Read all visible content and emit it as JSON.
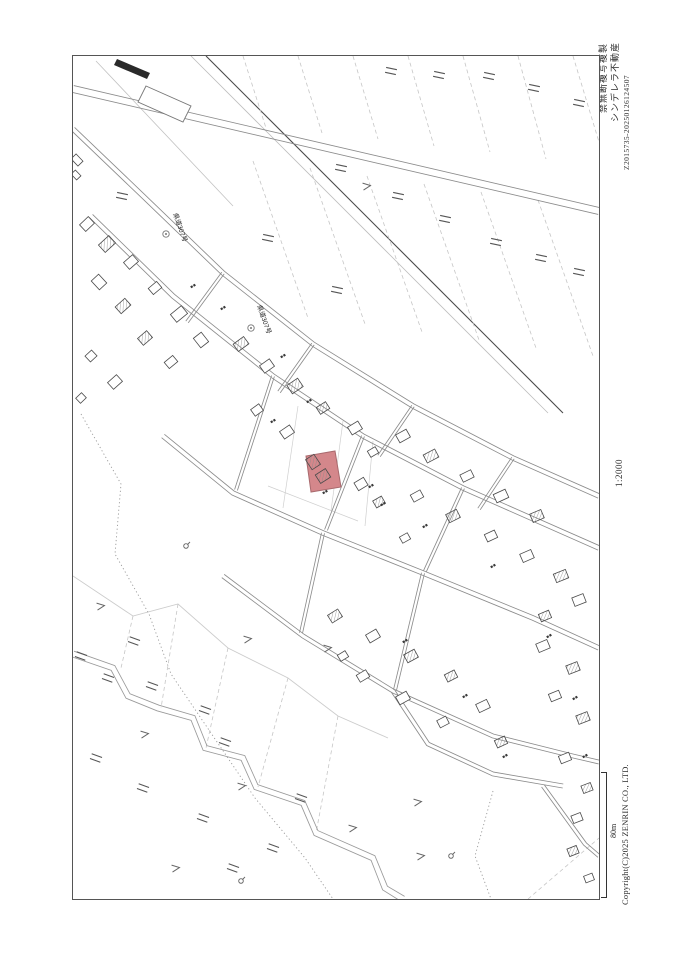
{
  "margin_labels": {
    "copy_prohibition": "禁無断複写複製",
    "company_name": "シンデレラ不動産",
    "print_code": "Z2015735-20250126124507",
    "map_scale": "1:2000",
    "scale_bar_length": "80m",
    "copyright": "Copyright(C)2025 ZENRIN CO., LTD."
  },
  "map": {
    "road_labels": [
      {
        "text": "県道307号"
      },
      {
        "text": "県道307号"
      }
    ],
    "highlight": {
      "color": "#d4878b",
      "border": "#a96a6e"
    }
  }
}
